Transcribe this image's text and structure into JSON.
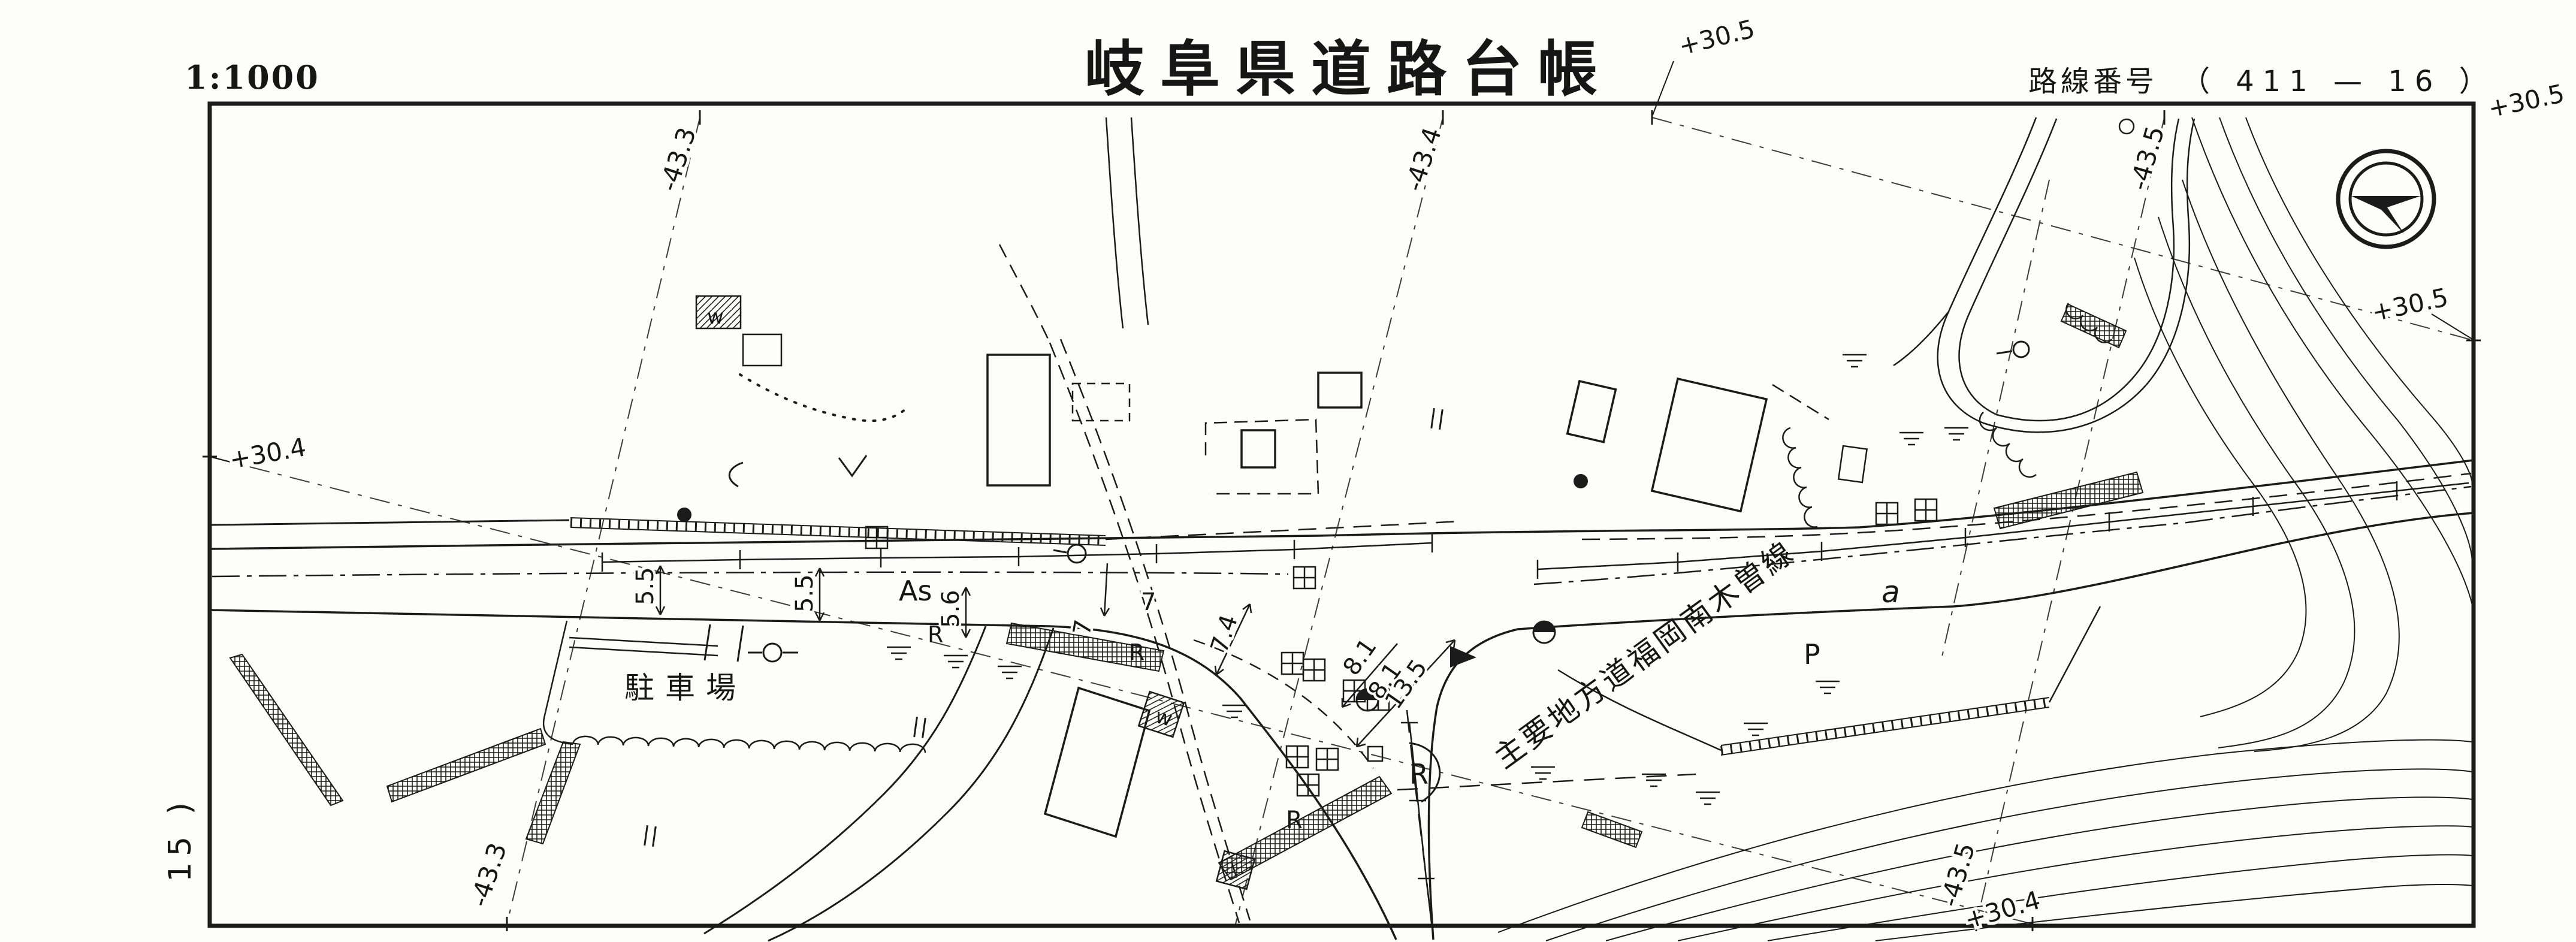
{
  "header": {
    "scale_label": "1:1000",
    "title": "岐阜県道路台帳",
    "route_caption": "路線番号",
    "route_number": "（ 411 — 16 ）"
  },
  "sheet": {
    "page_number": "15 )"
  },
  "grid": {
    "top_433": "-43.3",
    "top_434": "-43.4",
    "top_305": "+30.5",
    "top_435": "-43.5",
    "topright_305": "+30.5",
    "right_305": "+30.5",
    "left_304": "+30.4",
    "bottom_433": "-43.3",
    "bottom_435": "-43.5",
    "bottom_304": "+30.4"
  },
  "map": {
    "road_name": "主要地方道福岡南木曽線",
    "parking": "駐車場",
    "surface": "As",
    "parking_p": "P",
    "area_a": "a",
    "widths": {
      "w55a": "5.5",
      "w55b": "5.5",
      "w56": "5.6",
      "w7a": "7",
      "w7b": "7",
      "w74": "7.4",
      "w81a": "8.1",
      "w81b": "8.1",
      "w135": "13.5"
    },
    "r1": "R",
    "r2": "R",
    "r3": "R",
    "r4": "R",
    "r5": "R",
    "w1": "w",
    "w2": "w"
  }
}
